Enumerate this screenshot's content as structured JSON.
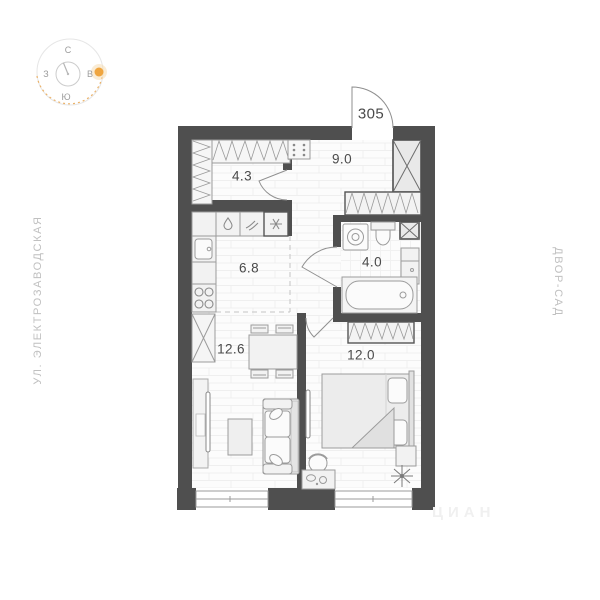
{
  "apartment": {
    "number": "305"
  },
  "compass": {
    "north": "С",
    "east": "В",
    "south": "Ю",
    "west": "З"
  },
  "streets": {
    "left": "УЛ. ЭЛЕКТРОЗАВОДСКАЯ",
    "right": "ДВОР-САД"
  },
  "rooms": [
    {
      "name": "entry-wardrobe",
      "area": "4.3"
    },
    {
      "name": "hallway",
      "area": "9.0"
    },
    {
      "name": "kitchen",
      "area": "6.8"
    },
    {
      "name": "bathroom",
      "area": "4.0"
    },
    {
      "name": "living-room",
      "area": "12.6"
    },
    {
      "name": "bedroom",
      "area": "12.0"
    }
  ],
  "watermark": "ЦИАН",
  "colors": {
    "wall": "#4f4f4f",
    "label": "#4a4a4a",
    "side-label": "#c0c0c0",
    "sun": "#efa53f",
    "furniture-line": "#9b9b9b",
    "floor-line": "#efefef"
  }
}
